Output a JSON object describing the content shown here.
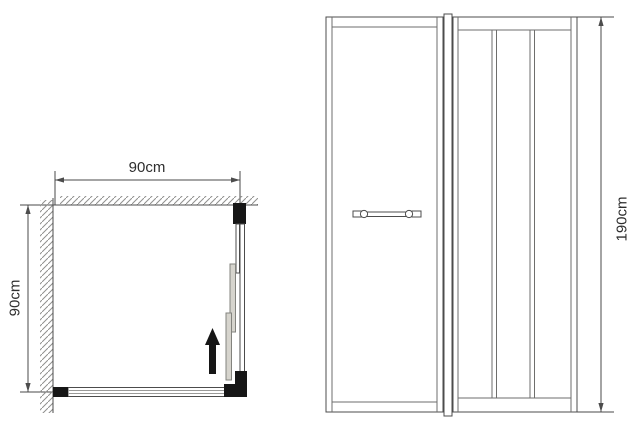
{
  "drawing": {
    "type": "shower-enclosure-dimension-diagram",
    "plan_view": {
      "width_label": "90cm",
      "depth_label": "90cm"
    },
    "elevation_view": {
      "height_label": "190cm"
    },
    "colors": {
      "line": "#4c4c4c",
      "light_line": "#9a9a98",
      "hatch": "#8f8f8d",
      "black_profile": "#161616",
      "panel_fill": "#d6d4cd",
      "panel_stroke": "#83837e",
      "text": "#2e2e2e",
      "background": "#ffffff"
    }
  }
}
